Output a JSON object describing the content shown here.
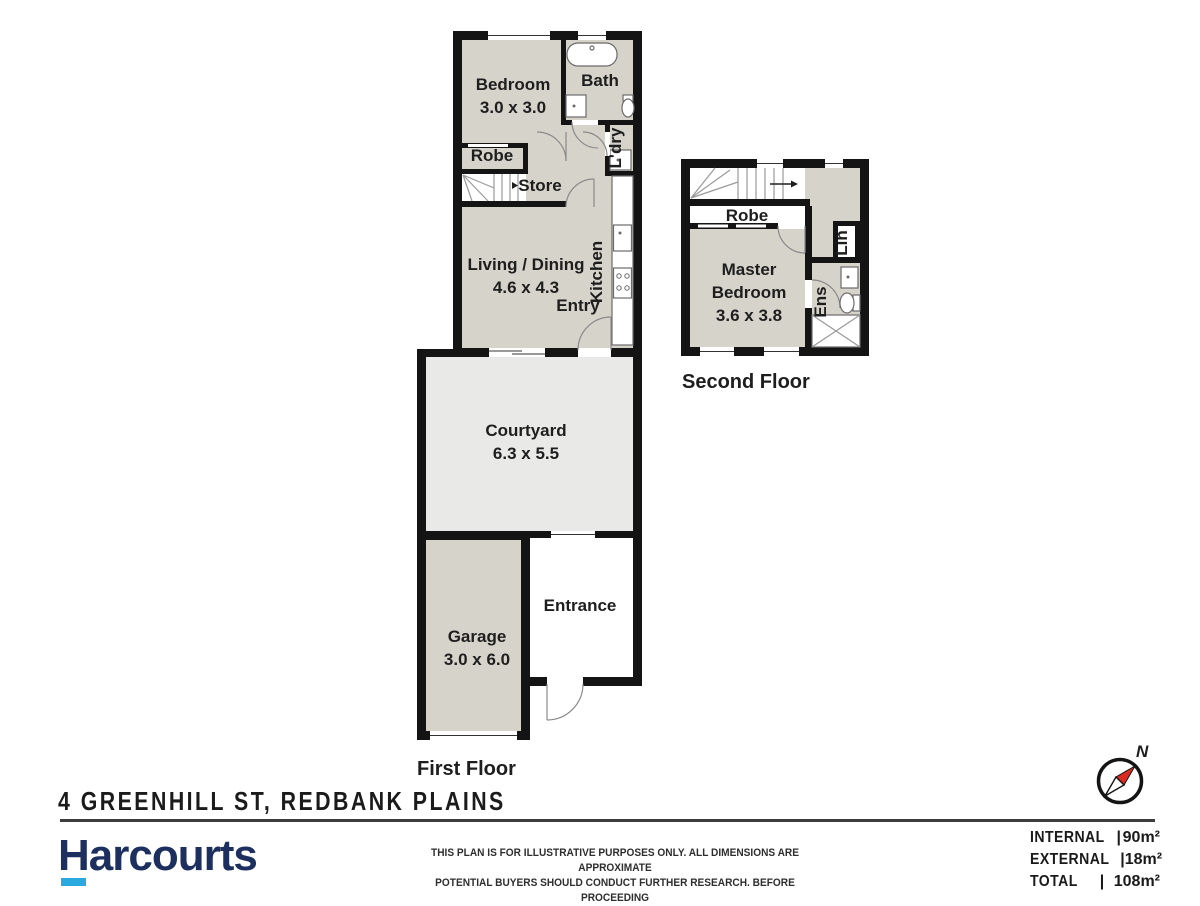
{
  "colors": {
    "wall": "#141414",
    "room_fill": "#d6d3cb",
    "courtyard_fill": "#e9e9e8",
    "brand_navy": "#1c2f5e",
    "brand_cyan": "#2aa9e0",
    "needle_red": "#d92b1f"
  },
  "plan": {
    "first_floor": {
      "label": "First Floor",
      "rooms": {
        "bedroom": {
          "name": "Bedroom",
          "dims": "3.0 x 3.0"
        },
        "bath": {
          "name": "Bath"
        },
        "robe": {
          "name": "Robe"
        },
        "store": {
          "name": "Store"
        },
        "laundry": {
          "name": "L'dry"
        },
        "living": {
          "name": "Living / Dining",
          "dims": "4.6 x 4.3"
        },
        "kitchen": {
          "name": "Kitchen"
        },
        "entry": {
          "name": "Entry"
        },
        "courtyard": {
          "name": "Courtyard",
          "dims": "6.3 x 5.5"
        },
        "garage": {
          "name": "Garage",
          "dims": "3.0 x 6.0"
        },
        "entrance": {
          "name": "Entrance"
        }
      }
    },
    "second_floor": {
      "label": "Second Floor",
      "rooms": {
        "robe": {
          "name": "Robe"
        },
        "master": {
          "line1": "Master",
          "line2": "Bedroom",
          "dims": "3.6 x 3.8"
        },
        "linen": {
          "name": "Lin"
        },
        "ensuite": {
          "name": "Ens"
        }
      }
    },
    "compass_label": "N"
  },
  "footer": {
    "address": "4 GREENHILL ST, REDBANK PLAINS",
    "brand": "Harcourts",
    "disclaimer_line1": "THIS PLAN IS FOR ILLUSTRATIVE PURPOSES ONLY.  ALL DIMENSIONS ARE APPROXIMATE",
    "disclaimer_line2": "POTENTIAL BUYERS SHOULD CONDUCT  FURTHER RESEARCH. BEFORE PROCEEDING",
    "areas": [
      {
        "label": "INTERNAL",
        "sep": "|",
        "value": "90m²"
      },
      {
        "label": "EXTERNAL",
        "sep": "|",
        "value": "18m²"
      },
      {
        "label": "TOTAL",
        "sep": "|",
        "value": "108m²"
      }
    ]
  }
}
